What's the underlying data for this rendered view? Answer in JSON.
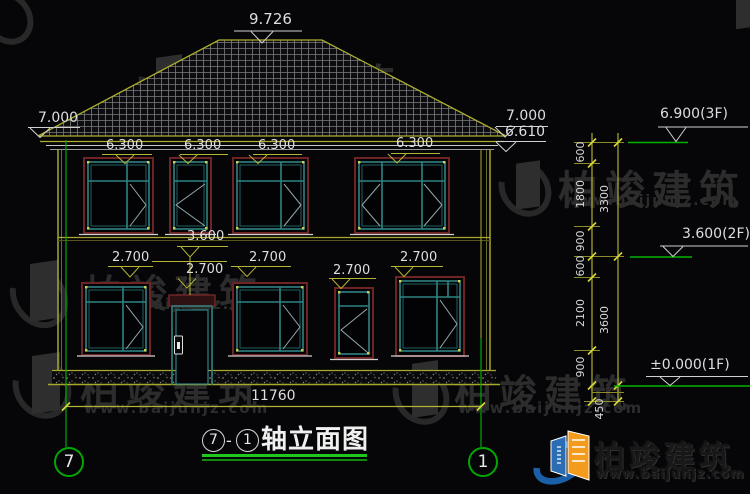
{
  "facade": {
    "ridge": "9.726",
    "eave_left": "7.000",
    "eave_right_upper": "7.000",
    "eave_right_lower": "6.610",
    "floor2_levels": [
      "6.300",
      "6.300",
      "6.300",
      "6.300"
    ],
    "entry_level": "3.600",
    "floor1_levels": [
      "2.700",
      "2.700",
      "2.700",
      "2.700",
      "2.700"
    ]
  },
  "right_levels": {
    "f3": "6.900(3F)",
    "f2": "3.600(2F)",
    "f1": "±0.000(1F)"
  },
  "dimensions": {
    "overall": "11760",
    "inner": [
      "600",
      "1800",
      "900",
      "600",
      "2100",
      "900"
    ],
    "outer": [
      "3300",
      "3600"
    ],
    "base": "450"
  },
  "axis_bubbles": {
    "left": "7",
    "right": "1"
  },
  "title": {
    "start": "7",
    "dash": "-",
    "end": "1",
    "label": "轴立面图"
  },
  "watermark": {
    "name": "柏竣建筑",
    "site": "www.baijunjz.com"
  },
  "brand": {
    "name": "柏竣建筑",
    "site": "www.baijunjz.com"
  },
  "colors": {
    "line_yellow": "#aeae2e",
    "axis_green": "#00a800",
    "window_teal": "#2f8383",
    "frame_maroon": "#6e2424",
    "text_white": "#dedede",
    "underline_green": "#1ec81e"
  }
}
